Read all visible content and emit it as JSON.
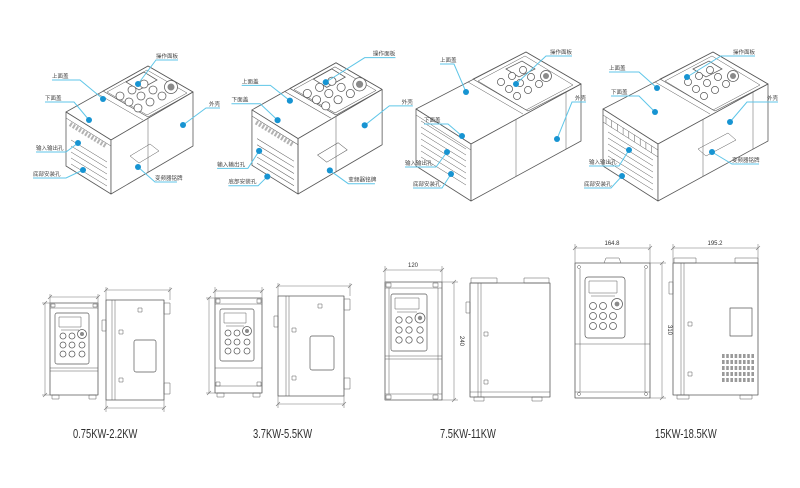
{
  "colors": {
    "leader_line": "#5fc6e8",
    "callout_dot": "#1794d2",
    "drawing_line": "#5a5a5a",
    "callout_text": "#444444",
    "power_label_text": "#2f2f2f",
    "background": "#ffffff"
  },
  "callouts": {
    "panel": "操作面板",
    "top_cover": "上面盖",
    "bottom_cover": "下面盖",
    "shell": "外壳",
    "io_holes": "输入输出孔",
    "mount_holes": "底部安装孔",
    "nameplate": "变频器铭牌"
  },
  "units": [
    {
      "name": "isometric-view-1",
      "callouts": [
        "panel",
        "top_cover",
        "bottom_cover",
        "shell",
        "io_holes",
        "mount_holes",
        "nameplate"
      ]
    },
    {
      "name": "isometric-view-2",
      "callouts": [
        "panel",
        "top_cover",
        "bottom_cover",
        "shell",
        "io_holes",
        "mount_holes",
        "nameplate"
      ]
    },
    {
      "name": "isometric-view-3",
      "callouts": [
        "panel",
        "top_cover",
        "bottom_cover",
        "shell",
        "io_holes",
        "mount_holes"
      ]
    },
    {
      "name": "isometric-view-4",
      "callouts": [
        "panel",
        "top_cover",
        "bottom_cover",
        "shell",
        "io_holes",
        "mount_holes",
        "nameplate"
      ]
    }
  ],
  "groups": [
    {
      "label": "0.75KW-2.2KW",
      "dims": {}
    },
    {
      "label": "3.7KW-5.5KW",
      "dims": {}
    },
    {
      "label": "7.5KW-11KW",
      "dims": {
        "front_width": "120",
        "front_height": "240"
      }
    },
    {
      "label": "15KW-18.5KW",
      "dims": {
        "front_width": "164.8",
        "front_height": "310",
        "side_width": "195.2"
      }
    }
  ]
}
